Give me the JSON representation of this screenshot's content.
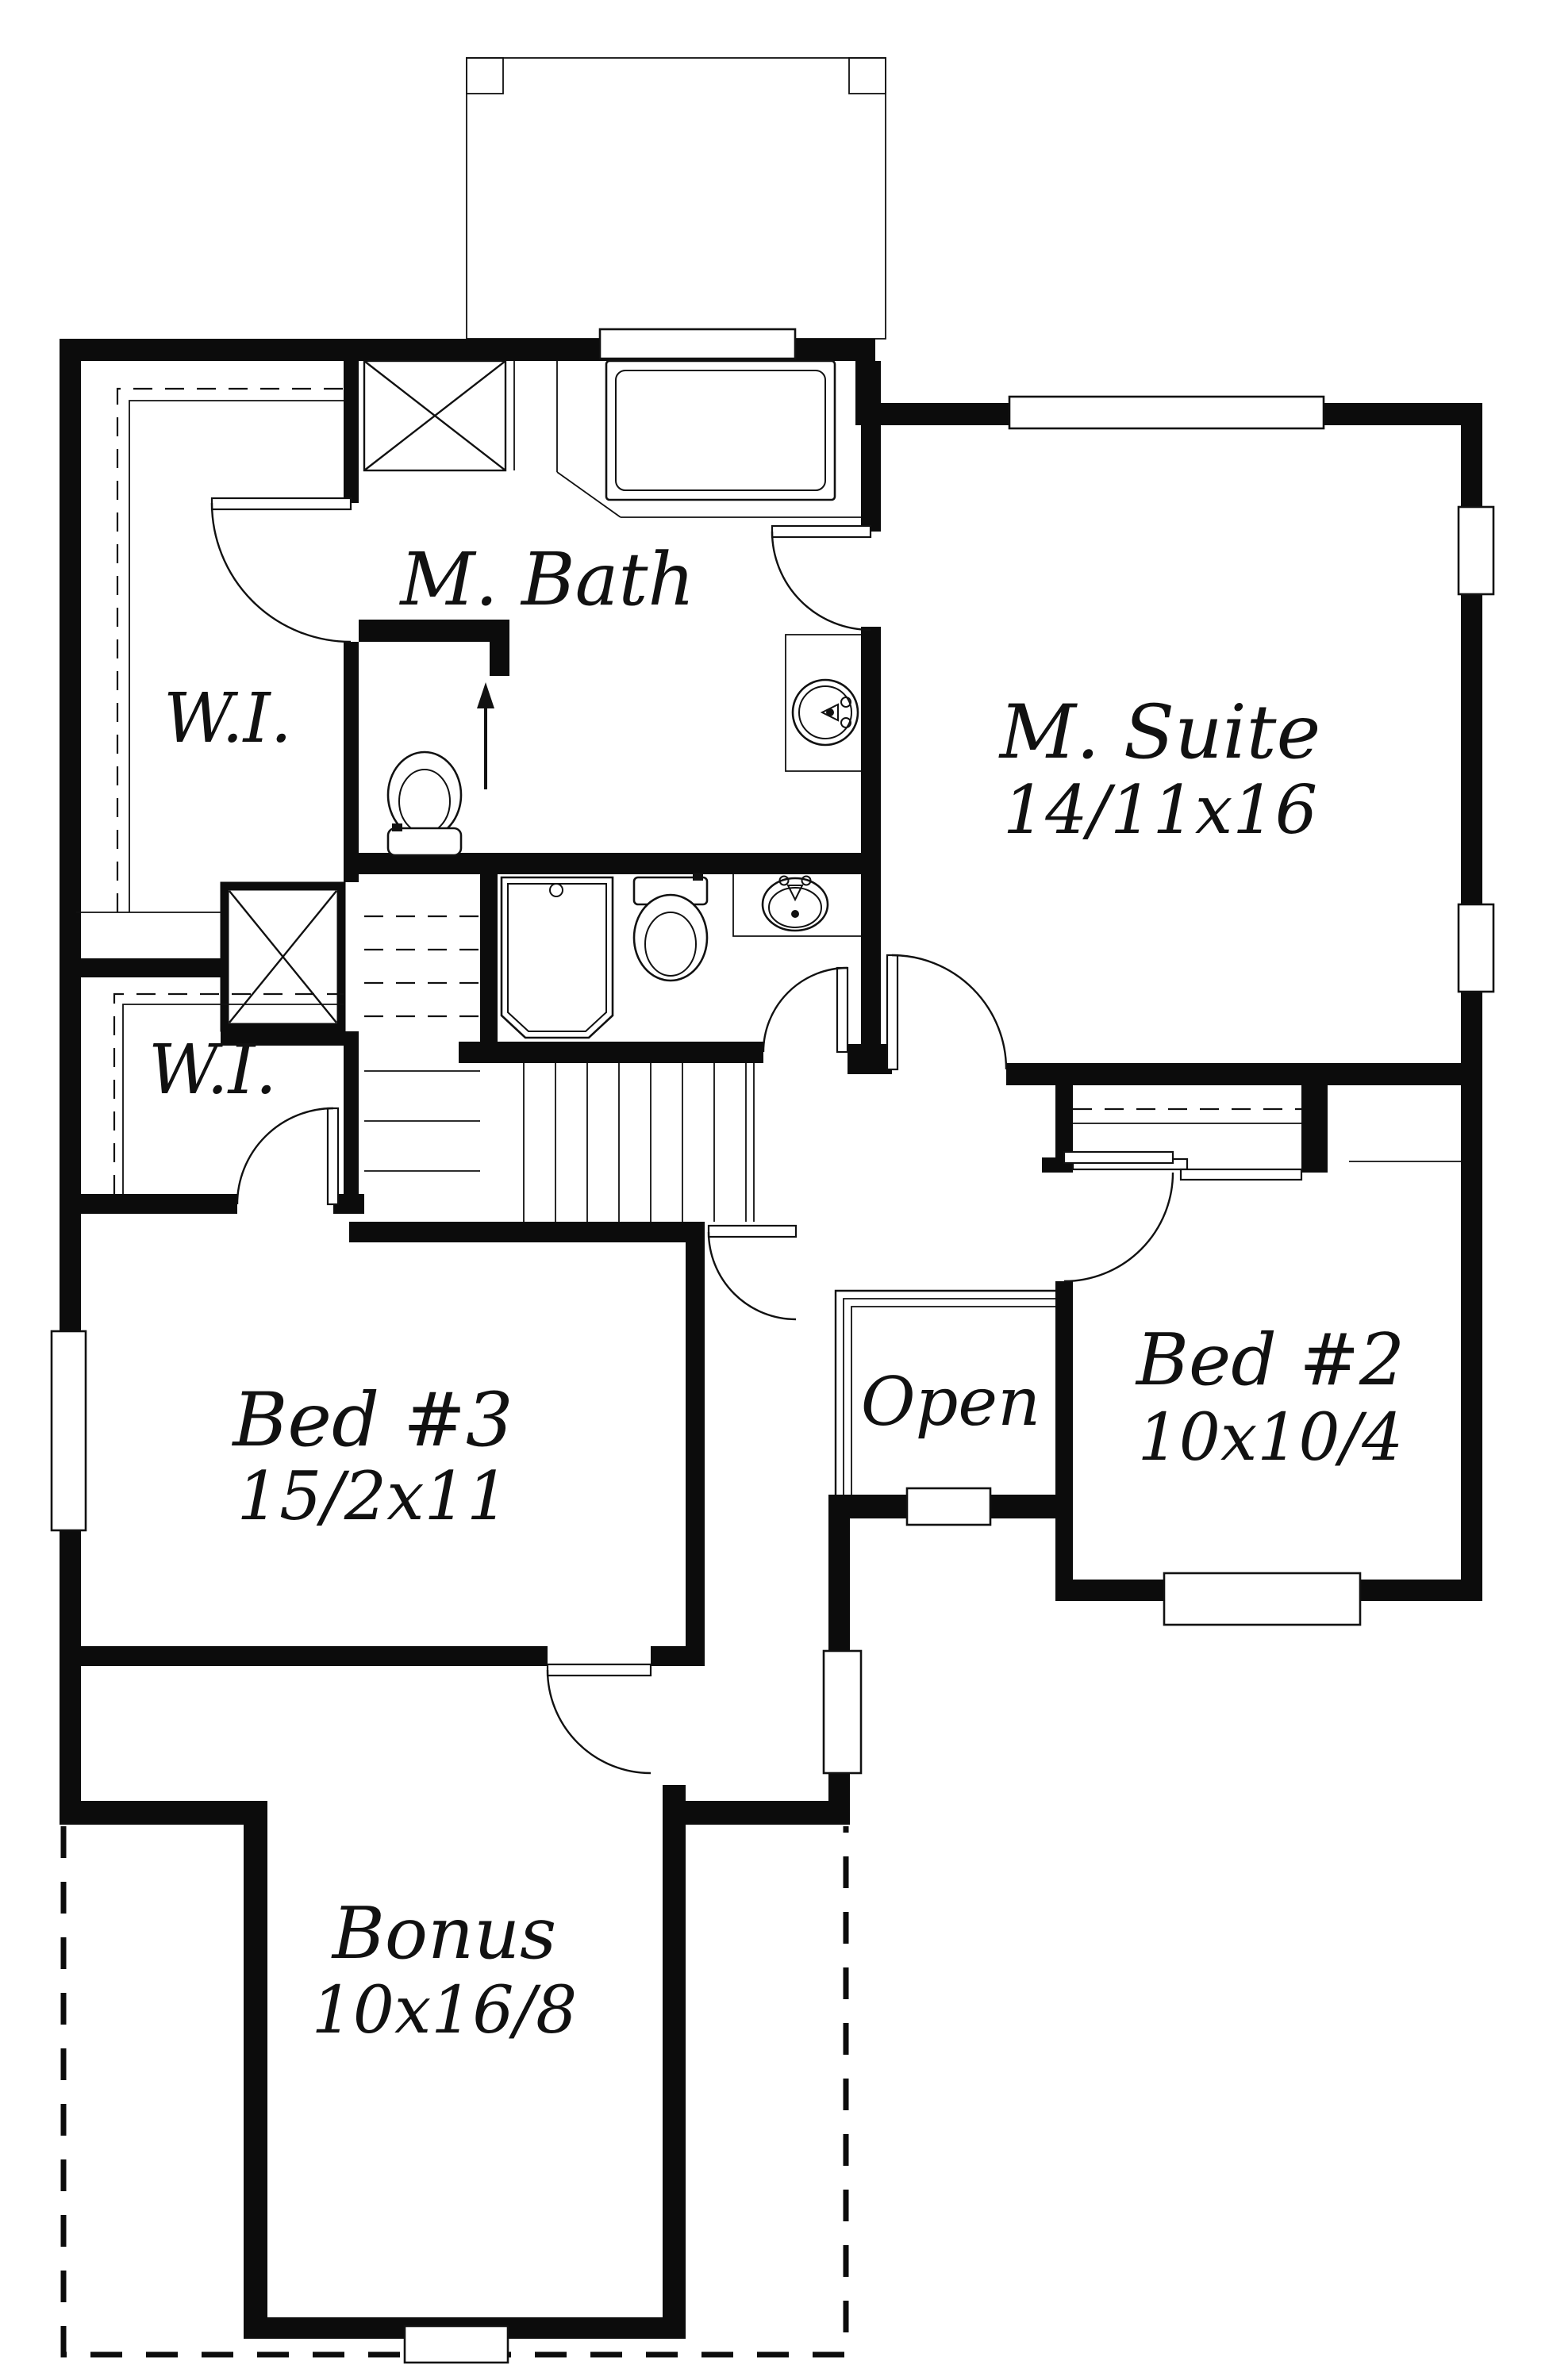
{
  "page": {
    "type": "floor-plan-drawing",
    "background_color": "#ffffff",
    "wall_color": "#0c0c0c",
    "line_color": "#111111"
  },
  "rooms": {
    "m_bath": {
      "label": "M. Bath"
    },
    "wi_upper": {
      "label": "W.I."
    },
    "wi_lower": {
      "label": "W.I."
    },
    "m_suite": {
      "label": "M. Suite",
      "dims": "14/11x16"
    },
    "bed3": {
      "label": "Bed #3",
      "dims": "15/2x11"
    },
    "open_below": {
      "label": "Open"
    },
    "bed2": {
      "label": "Bed #2",
      "dims": "10x10/4"
    },
    "bonus": {
      "label": "Bonus",
      "dims": "10x16/8"
    }
  },
  "symbols": {
    "stair_direction": "up",
    "fixtures": [
      "tub",
      "shower",
      "toilet",
      "toilet",
      "vanity-sink",
      "wc-sink"
    ],
    "closet_boxes": 2,
    "roofline": "dashed outline below (covered area)"
  }
}
